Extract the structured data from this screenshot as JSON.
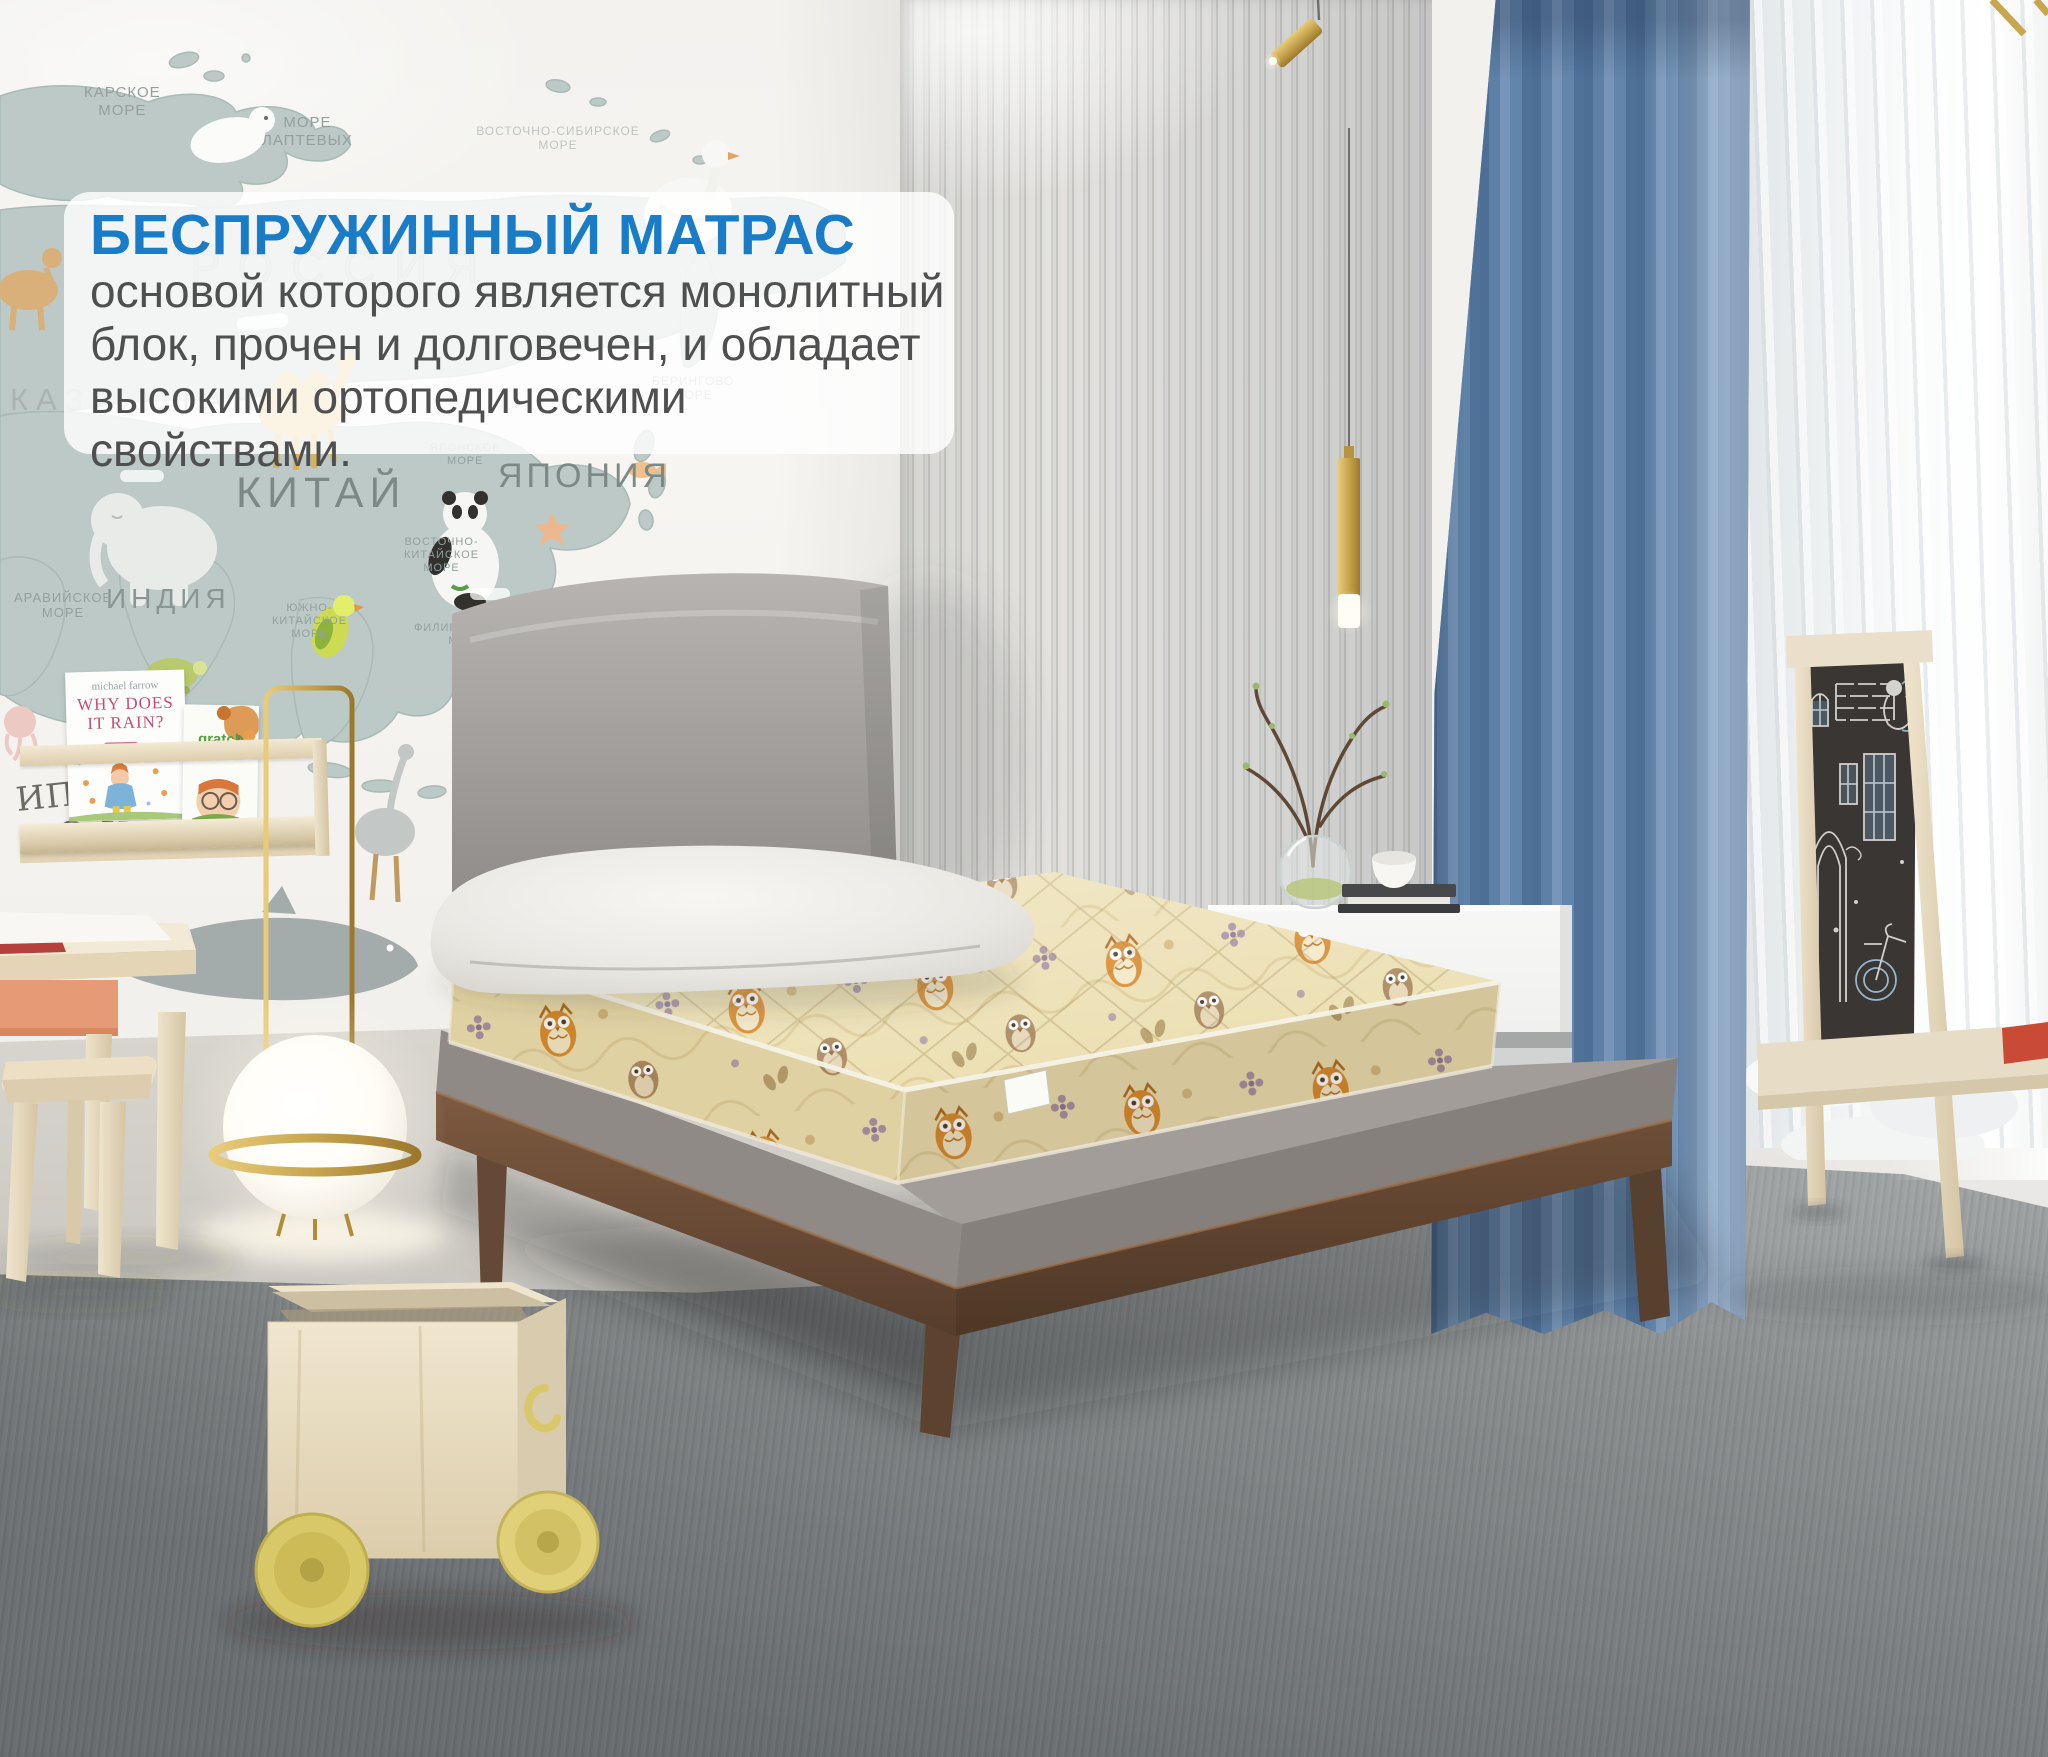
{
  "overlay": {
    "title": "БЕСПРУЖИННЫЙ МАТРАС",
    "lines": [
      "основой которого является монолитный",
      "блок, прочен и долговечен, и обладает",
      "высокими ортопедическими свойствами."
    ],
    "title_color": "#1a7cc6",
    "text_color": "#4f4f4f",
    "background": "rgba(255,255,255,0.82)"
  },
  "wall_map": {
    "labels": {
      "kara_sea": "КАРСКОЕ\nМОРЕ",
      "laptev_sea": "МОРЕ\nЛАПТЕВЫХ",
      "east_siberian_sea": "ВОСТОЧНО-СИБИРСКОЕ\nМОРЕ",
      "bering_sea": "БЕРИНГОВО\nМОРЕ",
      "russia": "РОССИЯ",
      "kazakhstan": "КАЗАХСТАН",
      "china": "КИТАЙ",
      "india": "ИНДИЯ",
      "japan": "ЯПОНИЯ",
      "japan_sea": "ЯПОНСКОЕ\nМОРЕ",
      "east_china_sea": "ВОСТОЧНО-\nКИТАЙСКОЕ\nМОРЕ",
      "south_china_sea": "ЮЖНО-\nКИТАЙСКОЕ\nМОРЕ",
      "philippine_sea": "ФИЛИППИНСКОЕ\nМОРЕ",
      "arabian_sea": "АРАВИЙСКОЕ\nМОРЕ",
      "pacific_ocean": "ТИХИЙ\nОКЕАН",
      "indian_ocean": "ОКЕАН",
      "indian_ocean_partial": "ип"
    }
  },
  "bookshelf": {
    "book1_author": "michael farrow",
    "book1_title": "WHY DOES\nIT RAIN?",
    "book2_title": "gratch",
    "book2_subtitle": "butterfly"
  },
  "palette": {
    "curtain_blue": "#5e80a6",
    "mattress_cream": "#ecdfb2",
    "owl_orange": "#d8892b",
    "wood_walnut": "#6a4a34",
    "birch_wood": "#e9dcc0",
    "wheel_yellow": "#d9c868",
    "carpet_gray": "#8a8e8f"
  }
}
